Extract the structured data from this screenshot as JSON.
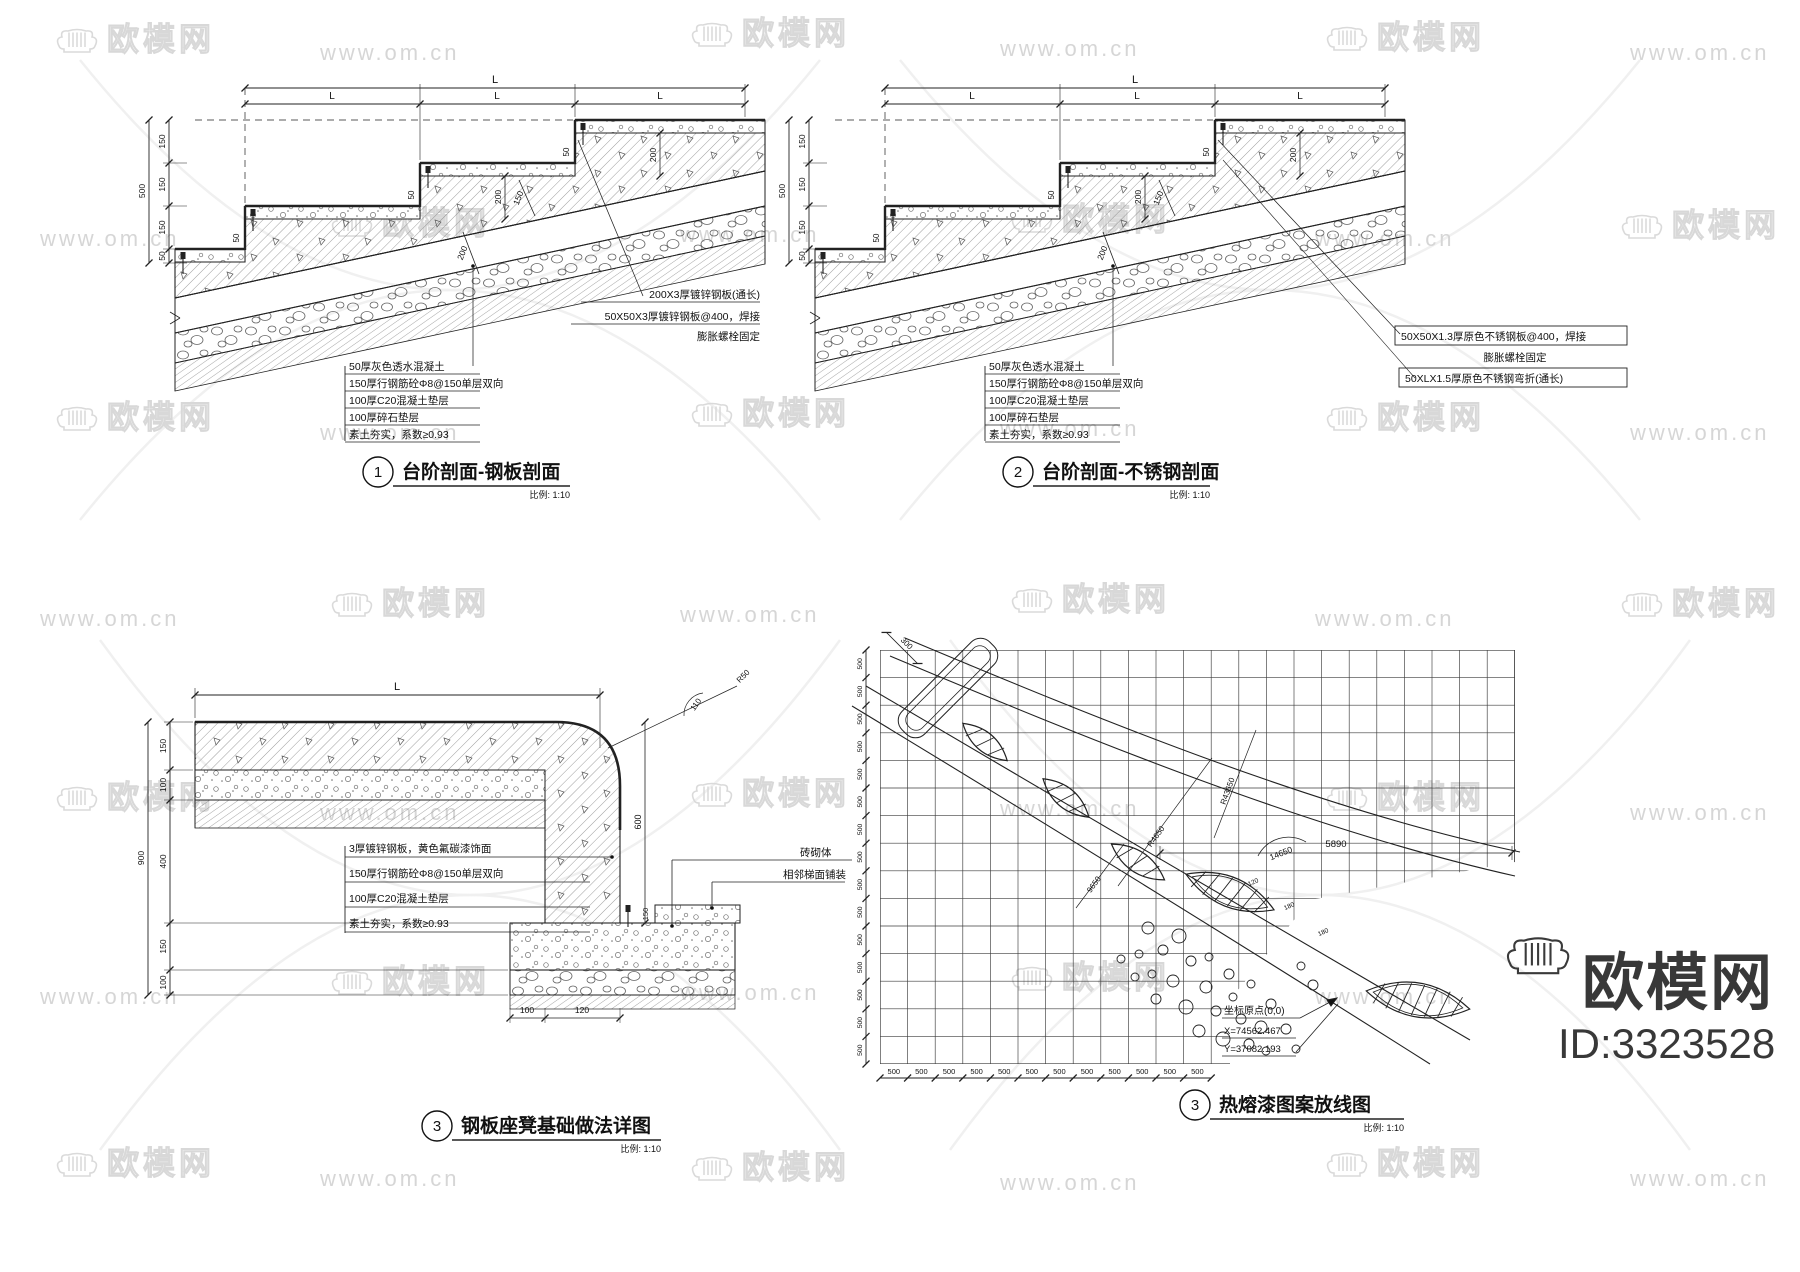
{
  "watermark": {
    "url_text": "www.om.cn",
    "brand_text": "欧模网"
  },
  "brand_logo": {
    "brand": "欧模网",
    "id_label": "ID:3323528"
  },
  "stair1": {
    "number": "1",
    "title": "台阶剖面-钢板剖面",
    "scale_label": "比例: 1:10",
    "overall_top": "L",
    "top_dims": [
      "L",
      "L",
      "L"
    ],
    "overall_left": "500",
    "left_dims": [
      "150",
      "150",
      "150",
      "50"
    ],
    "riser_dims": [
      "200",
      "200"
    ],
    "plate_dims": [
      "50",
      "50",
      "50"
    ],
    "diag_dims": [
      "150",
      "200"
    ],
    "notes": [
      "50厚灰色透水混凝土",
      "150厚行钢筋砼Φ8@150单层双向",
      "100厚C20混凝土垫层",
      "100厚碎石垫层",
      "素土夯实，系数≥0.93"
    ],
    "callouts": [
      "200X3厚镀锌钢板(通长)",
      "50X50X3厚镀锌钢板@400，焊接",
      "膨胀螺栓固定"
    ]
  },
  "stair2": {
    "number": "2",
    "title": "台阶剖面-不锈钢剖面",
    "scale_label": "比例: 1:10",
    "overall_top": "L",
    "top_dims": [
      "L",
      "L",
      "L"
    ],
    "overall_left": "500",
    "left_dims": [
      "150",
      "150",
      "150",
      "50"
    ],
    "riser_dims": [
      "200",
      "200"
    ],
    "plate_dims": [
      "50",
      "50",
      "50"
    ],
    "diag_dims": [
      "150",
      "200"
    ],
    "notes": [
      "50厚灰色透水混凝土",
      "150厚行钢筋砼Φ8@150单层双向",
      "100厚C20混凝土垫层",
      "100厚碎石垫层",
      "素土夯实，系数≥0.93"
    ],
    "callouts": [
      "50X50X1.3厚原色不锈钢板@400，焊接",
      "膨胀螺栓固定",
      "50XLX1.5厚原色不锈钢弯折(通长)"
    ]
  },
  "bench": {
    "number": "3",
    "title": "钢板座凳基础做法详图",
    "scale_label": "比例: 1:10",
    "overall_top": "L",
    "overall_left": "900",
    "left_dims": [
      "150",
      "100",
      "400",
      "150",
      "100"
    ],
    "corner_radius_label": "R50",
    "corner_arc_label": "110",
    "height_dim": "600",
    "bottom_dims": [
      "100",
      "120"
    ],
    "pave_dim": "150",
    "labels": [
      "砖砌体",
      "相邻梯面铺装"
    ],
    "notes": [
      "3厚镀锌钢板，黄色氟碳漆饰面",
      "150厚行钢筋砼Φ8@150单层双向",
      "100厚C20混凝土垫层",
      "素土夯实，系数≥0.93"
    ]
  },
  "pattern": {
    "number": "3",
    "title": "热熔漆图案放线图",
    "scale_label": "比例: 1:10",
    "cell_dim": "500",
    "start_dim": "300",
    "radius_labels": [
      "R4650",
      "9650",
      "R43650",
      "14650"
    ],
    "small_dims": [
      "120",
      "180",
      "180"
    ],
    "span_dim": "5890",
    "origin_label": "坐标原点(0,0)",
    "origin_x": "X=74562.467",
    "origin_y": "Y=37082.193"
  }
}
